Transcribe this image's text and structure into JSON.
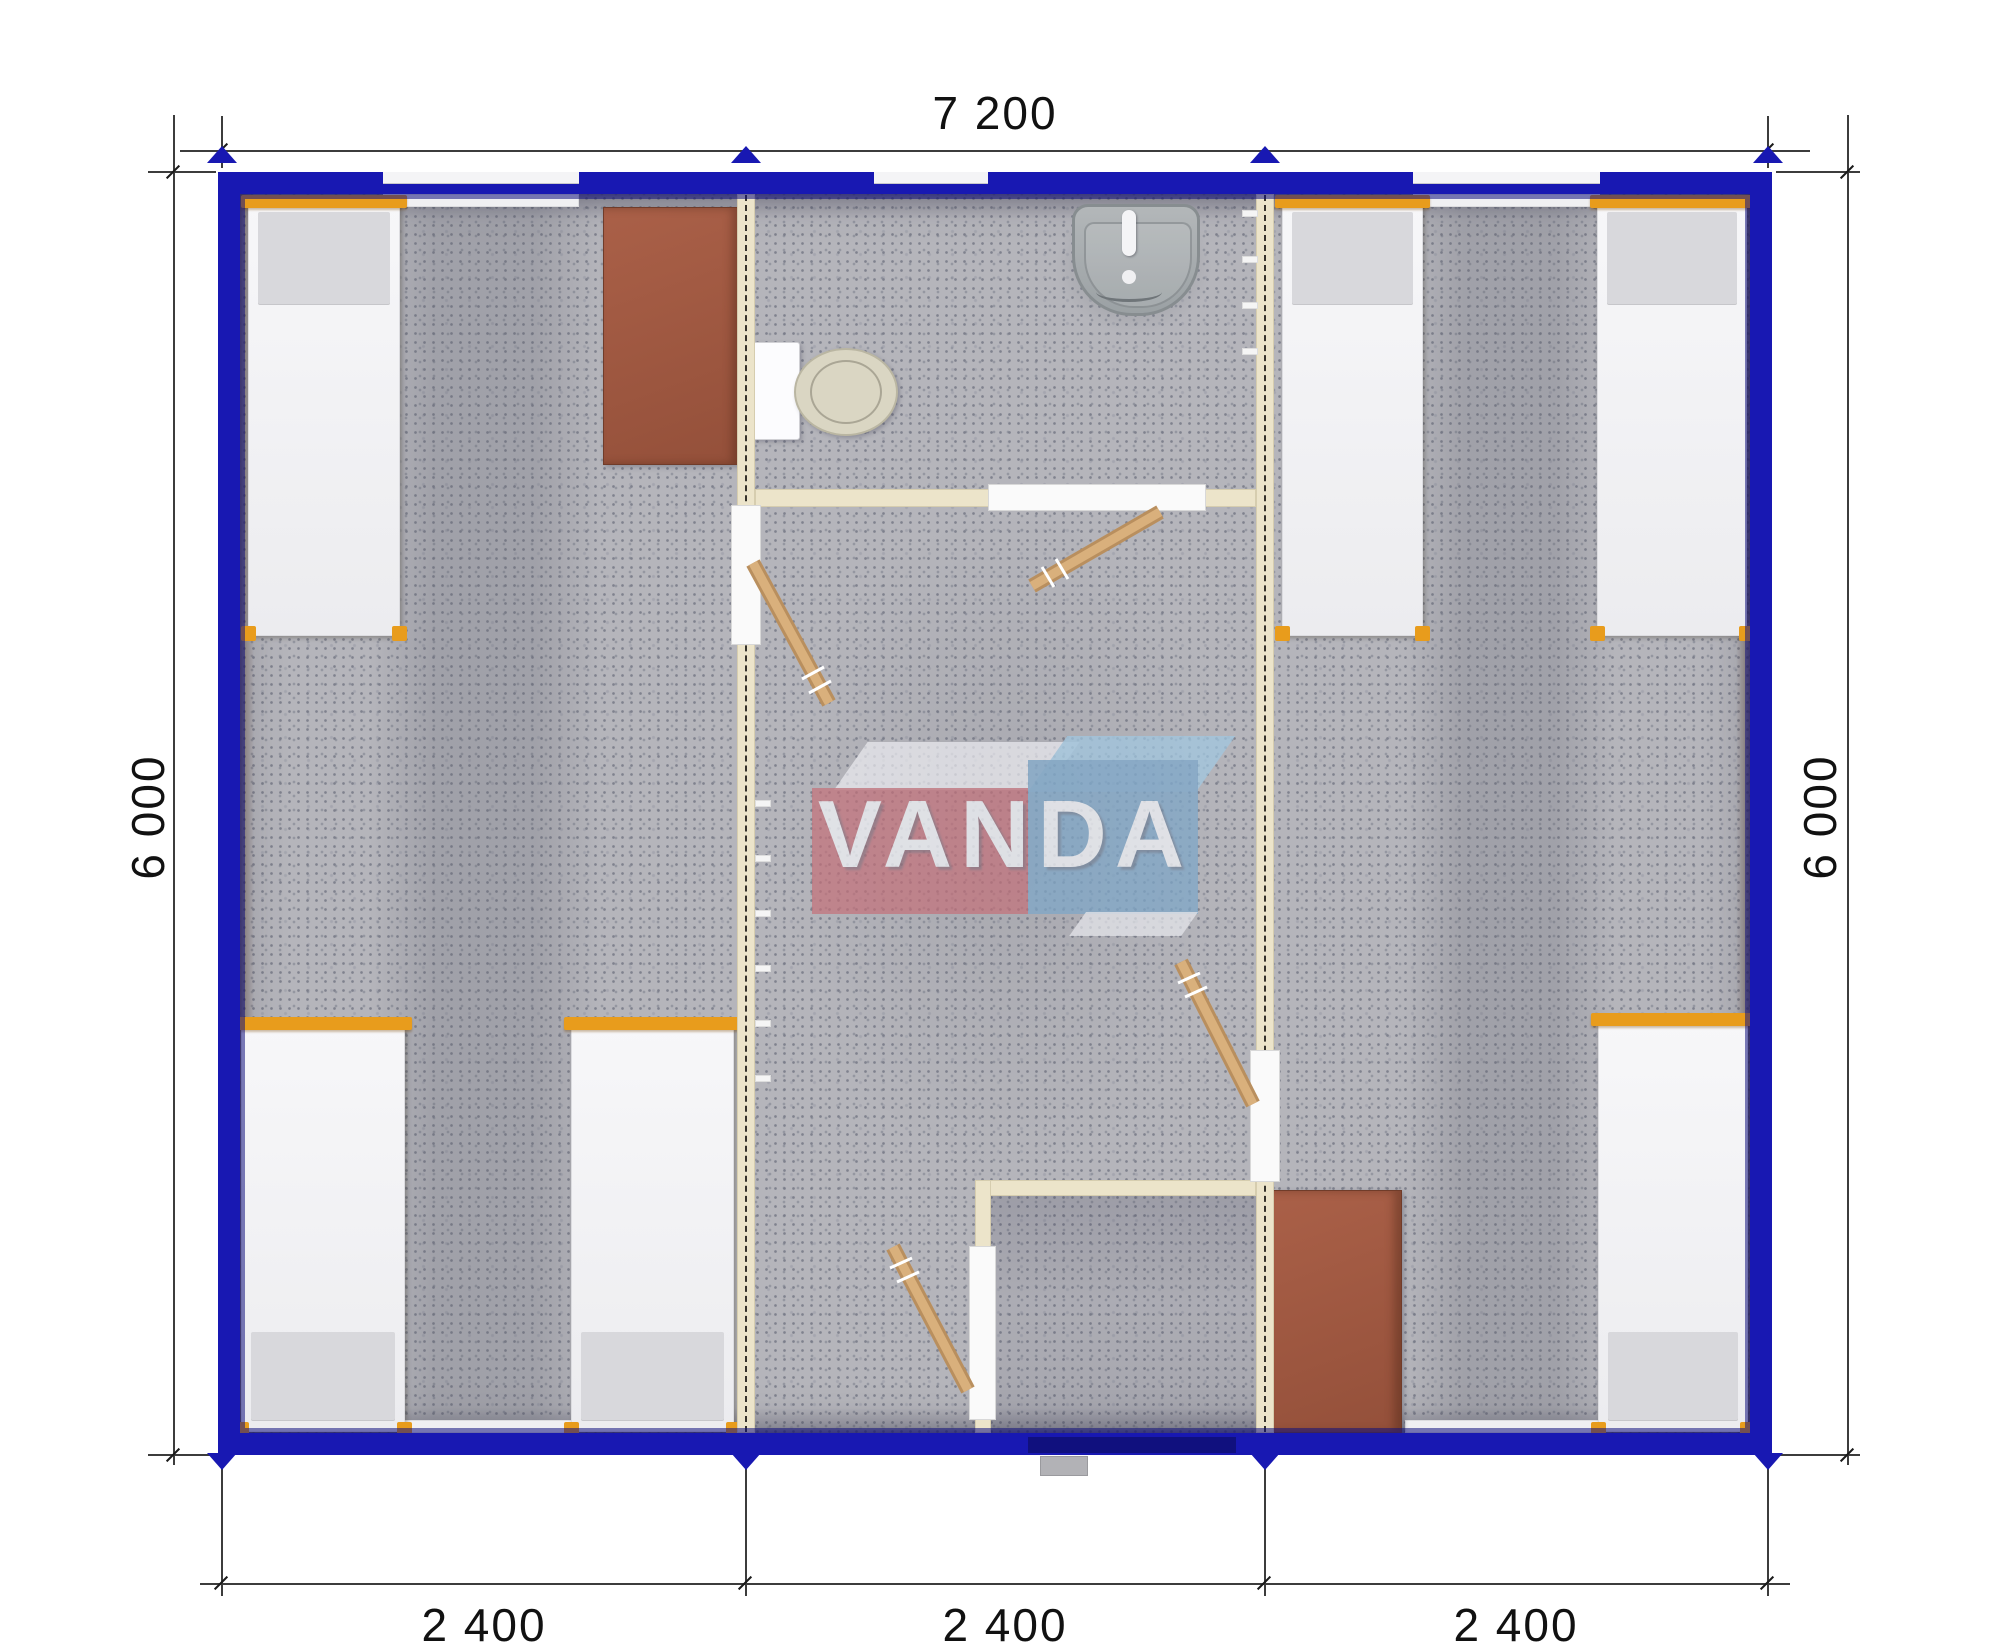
{
  "dimensions": {
    "top": "7 200",
    "left": "6 000",
    "right": "6 000",
    "bottom": [
      "2 400",
      "2 400",
      "2 400"
    ]
  },
  "watermark": {
    "text": "VANDA"
  },
  "colors": {
    "frame_blue": "#1818b2",
    "frame_navy": "#10107e",
    "partition_cream": "#ece4ca",
    "partition_edge": "#d6cdaf",
    "floor_gray": "#b5b5bb",
    "bed_orange": "#e89c1c",
    "mattress_white": "#f5f5f7",
    "pillow_gray": "#d8d8dc",
    "desk_brown": "#9d5a40",
    "door_wood": "#c89a66",
    "fixture_gray": "#a9adaf",
    "logo_red": "#c66e78",
    "logo_blue": "#7da6c8",
    "logo_blue_light": "#a0c8e2",
    "dim_text": "#111111"
  },
  "furniture_counts": {
    "beds": 6,
    "desks": 2,
    "toilets": 1,
    "sinks": 1,
    "door_leaves": 4
  }
}
